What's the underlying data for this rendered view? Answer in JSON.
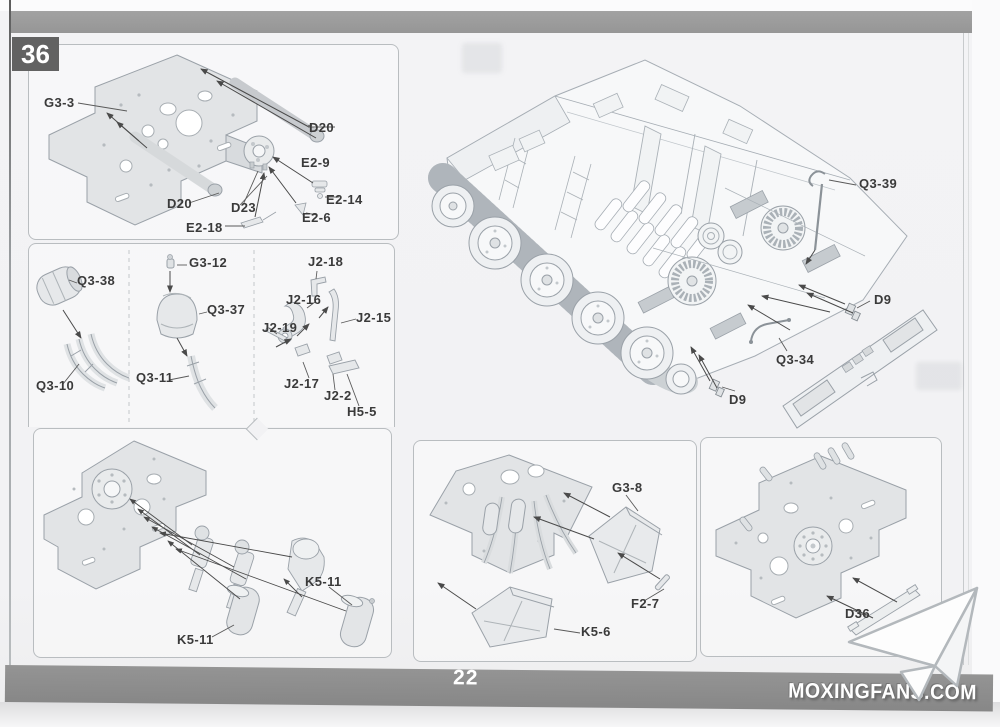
{
  "page": {
    "step": "36",
    "number": "22",
    "site": "MOXINGFANS.COM"
  },
  "labels": {
    "g3_3": "G3-3",
    "d20_a": "D20",
    "e2_9": "E2-9",
    "e2_14": "E2-14",
    "e2_6": "E2-6",
    "e2_18": "E2-18",
    "d23": "D23",
    "d20_b": "D20",
    "q3_38": "Q3-38",
    "q3_10": "Q3-10",
    "g3_12": "G3-12",
    "q3_37": "Q3-37",
    "q3_11": "Q3-11",
    "j2_18": "J2-18",
    "j2_16": "J2-16",
    "j2_15": "J2-15",
    "j2_19": "J2-19",
    "j2_17": "J2-17",
    "j2_2": "J2-2",
    "h5_5": "H5-5",
    "q3_39": "Q3-39",
    "d9_a": "D9",
    "q3_34": "Q3-34",
    "d9_b": "D9",
    "k5_11_a": "K5-11",
    "k5_11_b": "K5-11",
    "g3_8": "G3-8",
    "f2_7": "F2-7",
    "k5_6": "K5-6",
    "d36": "D36"
  },
  "colors": {
    "top_band": "#9c9c9c",
    "step_badge_bg": "#626262",
    "footer_bar": "#8d8d8d",
    "panel_border": "#b9bdc0",
    "line_art": "#9aa1a8",
    "label_text": "#3a3a3a",
    "arrow": "#4a4a4a"
  },
  "icons": {
    "logo": "paper-plane"
  }
}
